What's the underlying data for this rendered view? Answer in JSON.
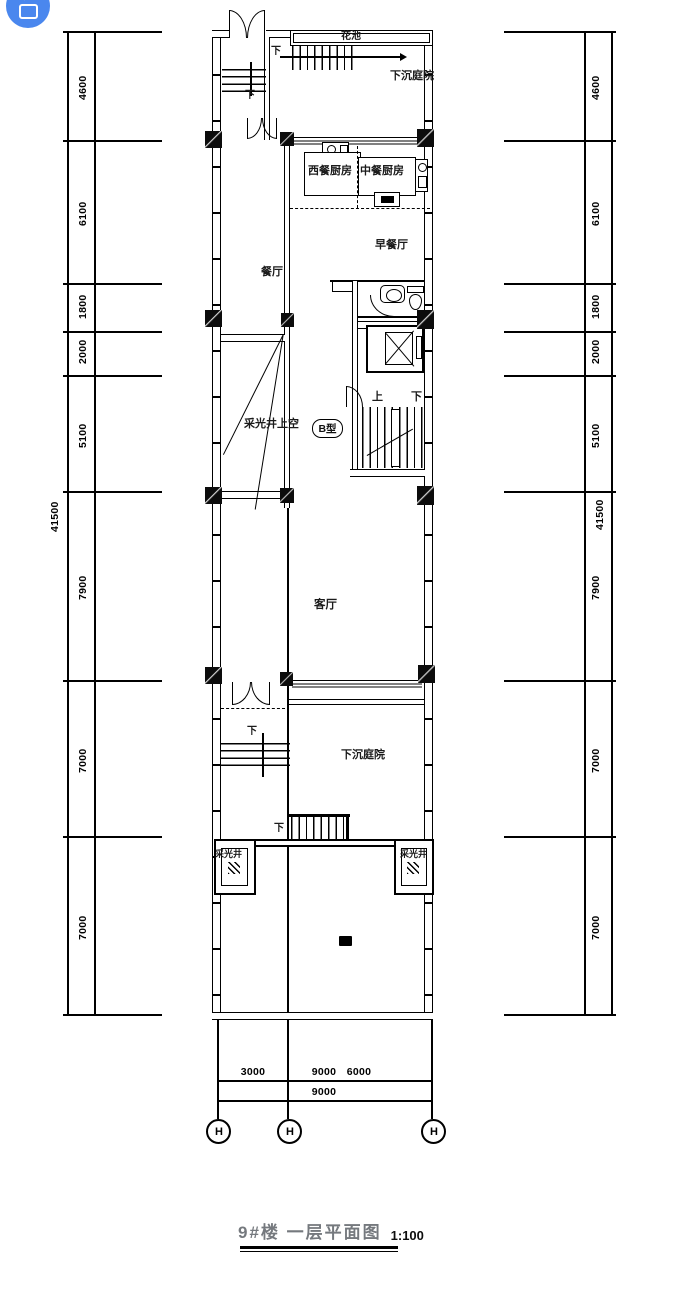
{
  "fab": {
    "icon": "share-icon"
  },
  "plan": {
    "rooms": {
      "flower_bed": "花池",
      "sunken_courtyard_top": "下沉庭院",
      "west_kitchen": "西餐厨房",
      "chinese_kitchen": "中餐厨房",
      "breakfast_room": "早餐厅",
      "dining_room": "餐厅",
      "light_well_above": "采光井上空",
      "living_room": "客厅",
      "sunken_courtyard_bottom": "下沉庭院",
      "light_well_left": "采光井",
      "light_well_right": "采光井"
    },
    "type_badge": "B型",
    "up": "上",
    "down": "下"
  },
  "dimensions": {
    "vertical_segments": [
      "4600",
      "6100",
      "1800",
      "2000",
      "5100",
      "7900",
      "7000",
      "7000"
    ],
    "vertical_total": "41500",
    "bottom_row1": [
      "3000",
      "9000",
      "6000"
    ],
    "bottom_row2": "9000",
    "grid_bubbles": [
      "H",
      "H",
      "H"
    ]
  },
  "title_block": {
    "title": "9#楼 一层平面图",
    "scale": "1:100"
  }
}
